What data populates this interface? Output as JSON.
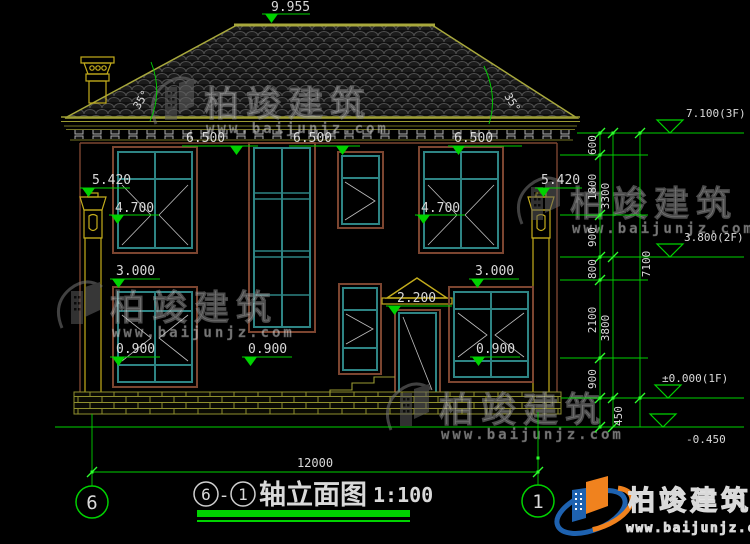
{
  "title": {
    "axis_start": "6",
    "axis_end": "1",
    "dash": "-",
    "name": "轴立面图",
    "scale": "1:100"
  },
  "axis_bubbles": {
    "left": "6",
    "right": "1"
  },
  "roof": {
    "ridge_elevation": "9.955",
    "angle_left": "35°",
    "angle_right": "35°"
  },
  "elevations": {
    "eave": [
      "6.500",
      "6.500",
      "6.500"
    ],
    "upper_left": "5.420",
    "upper_right": "5.420",
    "mid_left": "4.700",
    "mid_right": "4.700",
    "floor_left": "3.000",
    "floor_right": "3.000",
    "sill_left": "0.900",
    "sill_center": "0.900",
    "sill_right": "0.900",
    "canopy": "2.200",
    "f3": "7.100(3F)",
    "f2": "3.800(2F)",
    "f1": "±0.000(1F)",
    "ground": "-0.450"
  },
  "dims": {
    "total_width": "12000",
    "total_height": "7100",
    "foot": "450",
    "inner": [
      "600",
      "1800",
      "900",
      "800",
      "2100",
      "900"
    ],
    "mid": [
      "3300",
      "3800"
    ]
  },
  "watermark": {
    "name": "柏竣建筑",
    "url": "www.baijunjz.com"
  },
  "footer_logo": {
    "name": "柏竣建筑",
    "url": "www.baijunjz.com"
  },
  "colors": {
    "line_green": "#00d200",
    "cad_olive": "#9a9a32",
    "frame_brown": "#7c4530",
    "frame_teal": "#2e8484",
    "logo_blue": "#1e62b0",
    "logo_orange": "#f0821e"
  }
}
